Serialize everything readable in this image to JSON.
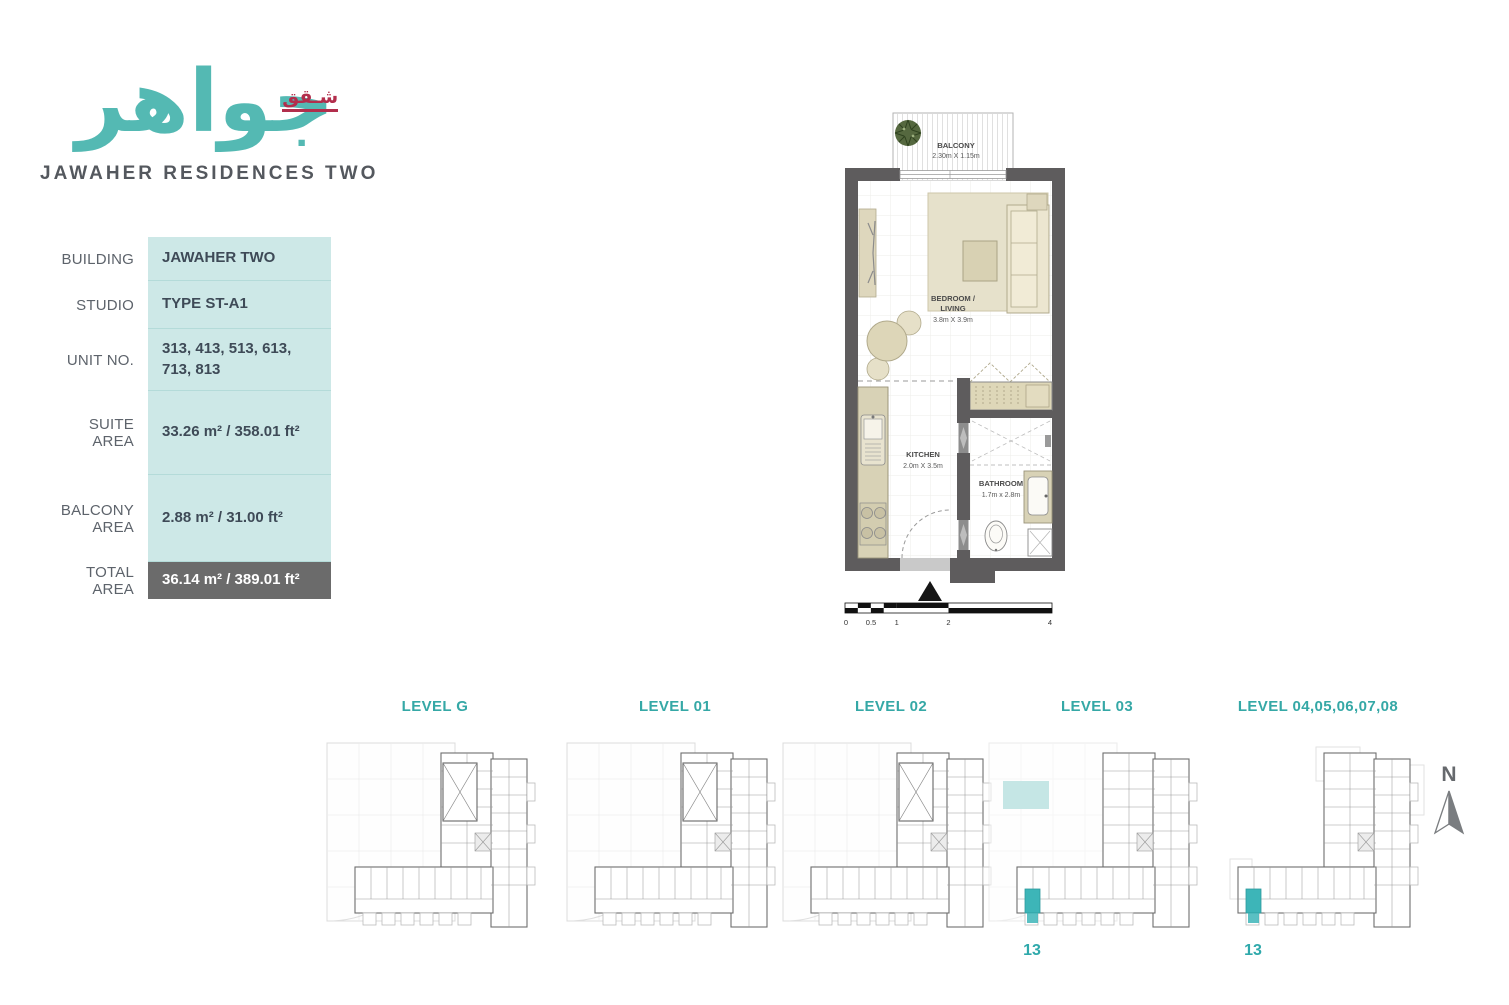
{
  "brand": {
    "logo_arabic": "جواهر",
    "logo_badge": "شـقق",
    "title": "JAWAHER RESIDENCES TWO"
  },
  "colors": {
    "teal": "#35a8a6",
    "logo_teal": "#54b9b3",
    "table_fill": "#cde8e7",
    "total_row_bg": "#6b6b6b",
    "wall_gray": "#5e5c5d",
    "badge_red": "#b22e4c",
    "unit_highlight": "#3db5b8"
  },
  "spec_table": {
    "rows": [
      {
        "label": "BUILDING",
        "value": "JAWAHER TWO"
      },
      {
        "label": "STUDIO",
        "value": "TYPE ST-A1"
      },
      {
        "label": "UNIT NO.",
        "value": "313, 413, 513, 613, 713, 813"
      },
      {
        "label": "SUITE AREA",
        "value": "33.26 m² / 358.01 ft²"
      },
      {
        "label": "BALCONY AREA",
        "value": "2.88 m² / 31.00 ft²"
      },
      {
        "label": "TOTAL AREA",
        "value": "36.14 m² / 389.01 ft²"
      }
    ]
  },
  "floor_plan": {
    "balcony": {
      "name": "BALCONY",
      "dims": "2.30m X 1.15m"
    },
    "bedroom": {
      "line1": "BEDROOM /",
      "line2": "LIVING",
      "dims": "3.8m X 3.9m"
    },
    "kitchen": {
      "name": "KITCHEN",
      "dims": "2.0m X 3.5m"
    },
    "bathroom": {
      "name": "BATHROOM",
      "dims": "1.7m x 2.8m"
    },
    "scale_ticks": [
      "0",
      "0.5",
      "1",
      "2",
      "4"
    ]
  },
  "levels": [
    {
      "label": "LEVEL G",
      "unit": ""
    },
    {
      "label": "LEVEL 01",
      "unit": ""
    },
    {
      "label": "LEVEL 02",
      "unit": ""
    },
    {
      "label": "LEVEL 03",
      "unit": "13"
    },
    {
      "label": "LEVEL 04,05,06,07,08",
      "unit": "13"
    }
  ],
  "compass": {
    "label": "N"
  }
}
